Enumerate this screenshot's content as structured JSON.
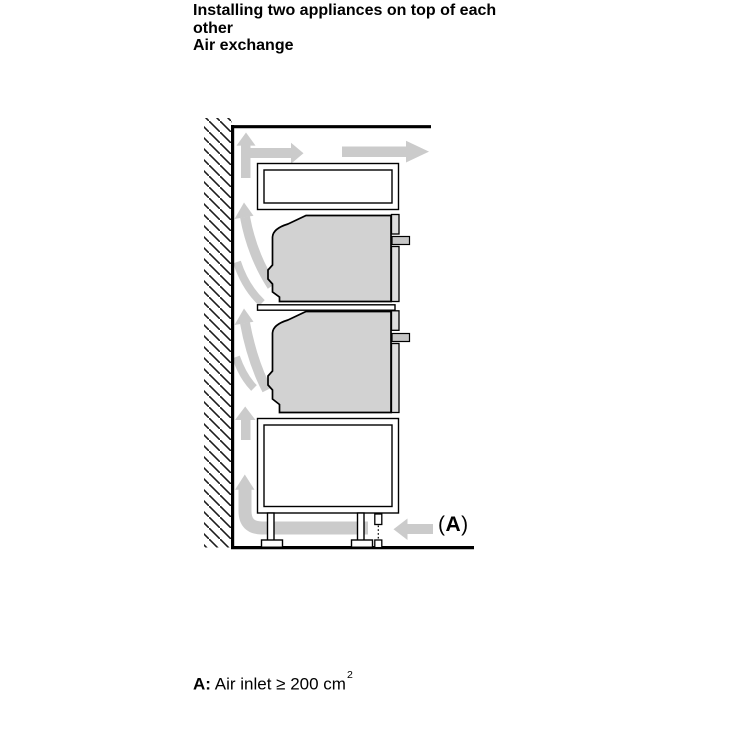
{
  "heading": {
    "line1": "Installing two appliances on top of each",
    "line2": "other",
    "line3": "Air exchange"
  },
  "figure_label_a": {
    "open": "(",
    "letter": "A",
    "close": ")"
  },
  "caption": {
    "label": "A:",
    "text": " Air inlet ≥ 200 cm",
    "sup": "2"
  },
  "colors": {
    "airflow_arrow": "#cbcbcb",
    "appliance_fill": "#d2d2d2",
    "appliance_front_fill": "#dedede",
    "handle_fill": "#c6c6c6",
    "outline": "#000000",
    "background": "#ffffff"
  }
}
